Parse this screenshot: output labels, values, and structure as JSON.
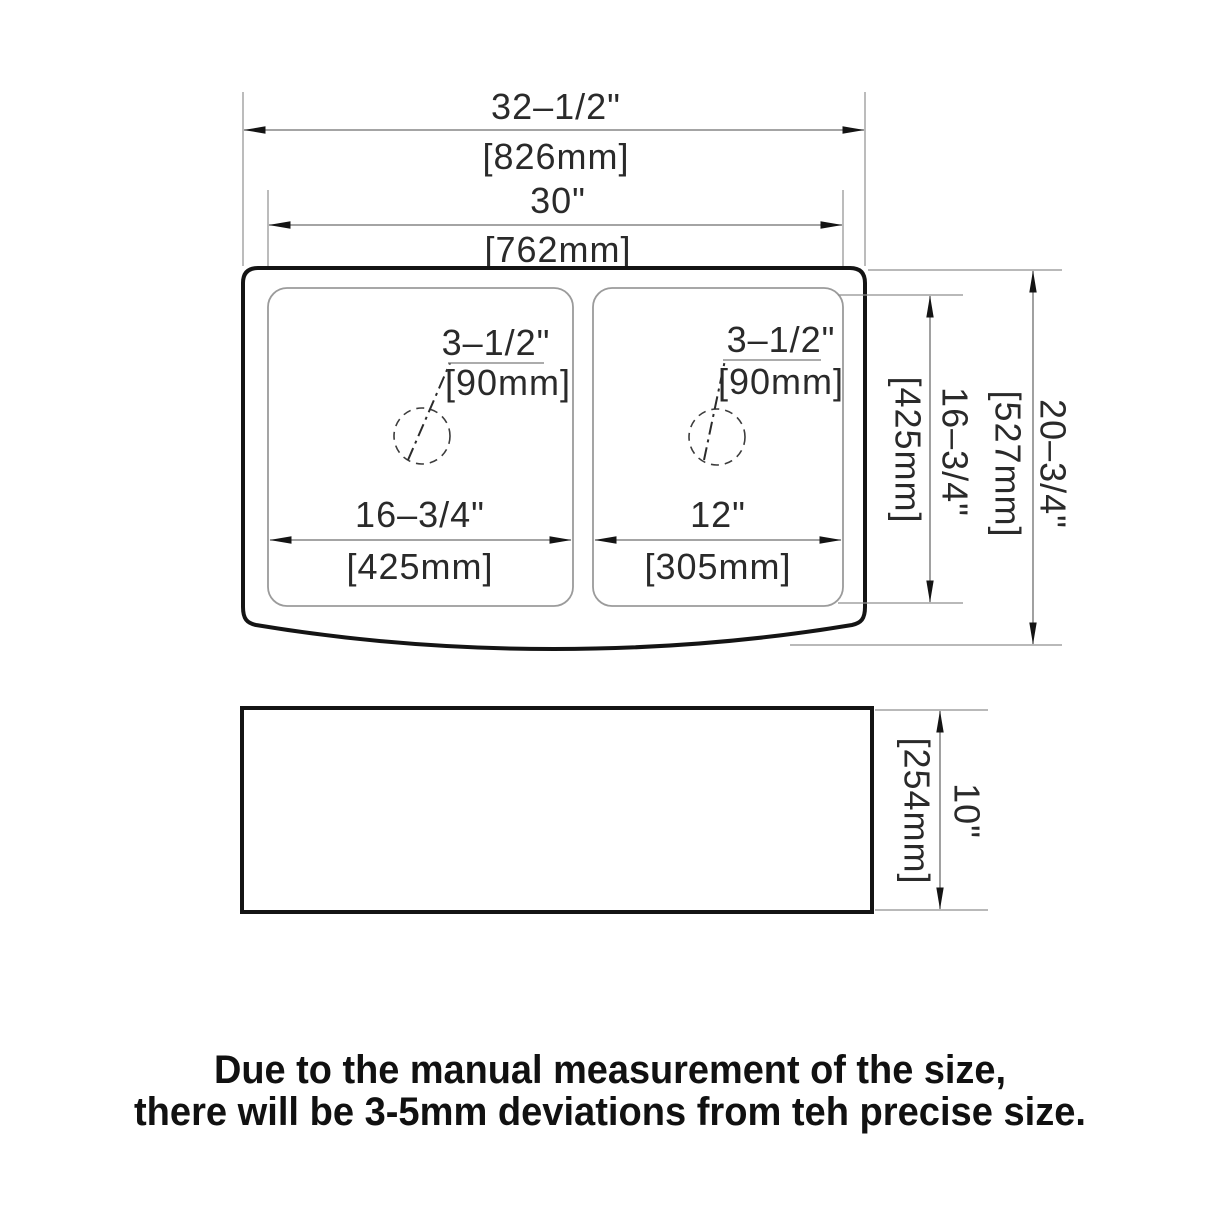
{
  "diagram": {
    "top_view": {
      "overall_width_in": "32–1/2\"",
      "overall_width_mm": "[826mm]",
      "bowl_span_in": "30\"",
      "bowl_span_mm": "[762mm]",
      "left_drain_in": "3–1/2\"",
      "left_drain_mm": "[90mm]",
      "right_drain_in": "3–1/2\"",
      "right_drain_mm": "[90mm]",
      "left_bowl_width_in": "16–3/4\"",
      "left_bowl_width_mm": "[425mm]",
      "right_bowl_width_in": "12\"",
      "right_bowl_width_mm": "[305mm]",
      "bowl_depth_in": "16–3/4\"",
      "bowl_depth_mm": "[425mm]",
      "overall_depth_in": "20–3/4\"",
      "overall_depth_mm": "[527mm]"
    },
    "side_view": {
      "height_in": "10\"",
      "height_mm": "[254mm]"
    },
    "note": {
      "line1": "Due to the manual measurement of the size,",
      "line2": "there will be 3-5mm deviations from teh precise size."
    },
    "colors": {
      "background": "#ffffff",
      "outline": "#141414",
      "bowl_line": "#9b9b9b",
      "dimension_line": "#6e6e6e",
      "text": "#2a2a2a"
    }
  }
}
